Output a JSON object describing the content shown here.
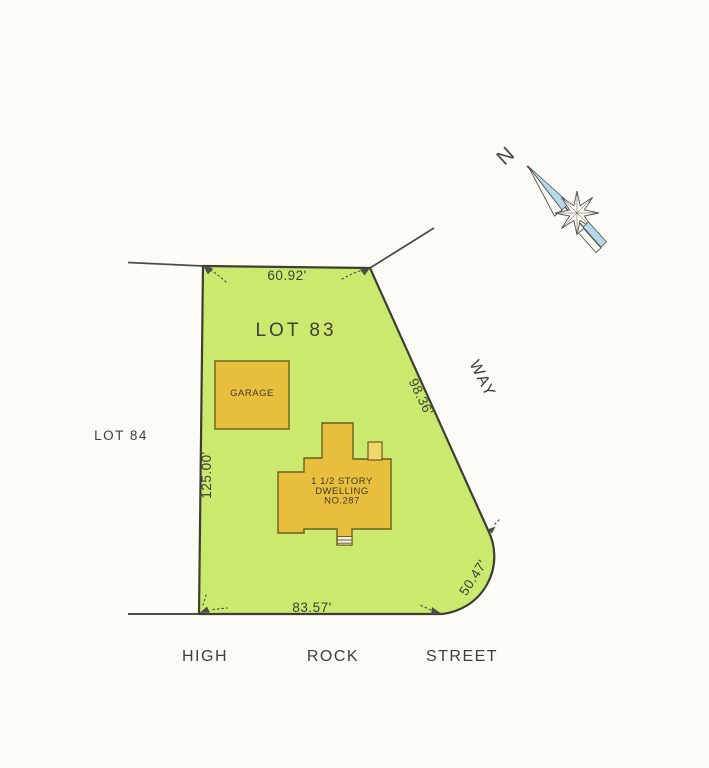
{
  "parcel": {
    "lot_label": "LOT 83",
    "adjacent_lot_label": "LOT 84",
    "dim_rear": "60.92'",
    "dim_way_frontage": "98.36'",
    "dim_left_side": "125.00'",
    "dim_street_frontage": "83.57'",
    "dim_corner_curve": "50.47'"
  },
  "buildings": {
    "garage_label": "GARAGE",
    "dwelling_line1": "1 1/2 STORY",
    "dwelling_line2": "DWELLING",
    "dwelling_line3": "NO.287"
  },
  "streets": {
    "way": "WAY",
    "high": "HIGH",
    "rock": "ROCK",
    "street": "STREET"
  },
  "compass": {
    "north_label": "N"
  },
  "colors": {
    "lot_fill": "#cbe96c",
    "lot_stroke": "#3c3f33",
    "building_fill": "#e8bf3d",
    "building_light": "#f0d76a",
    "building_stroke": "#6b5e25",
    "line": "#4c4c48",
    "compass_blue": "#b5d8ea",
    "paper": "#fcfbf6"
  }
}
